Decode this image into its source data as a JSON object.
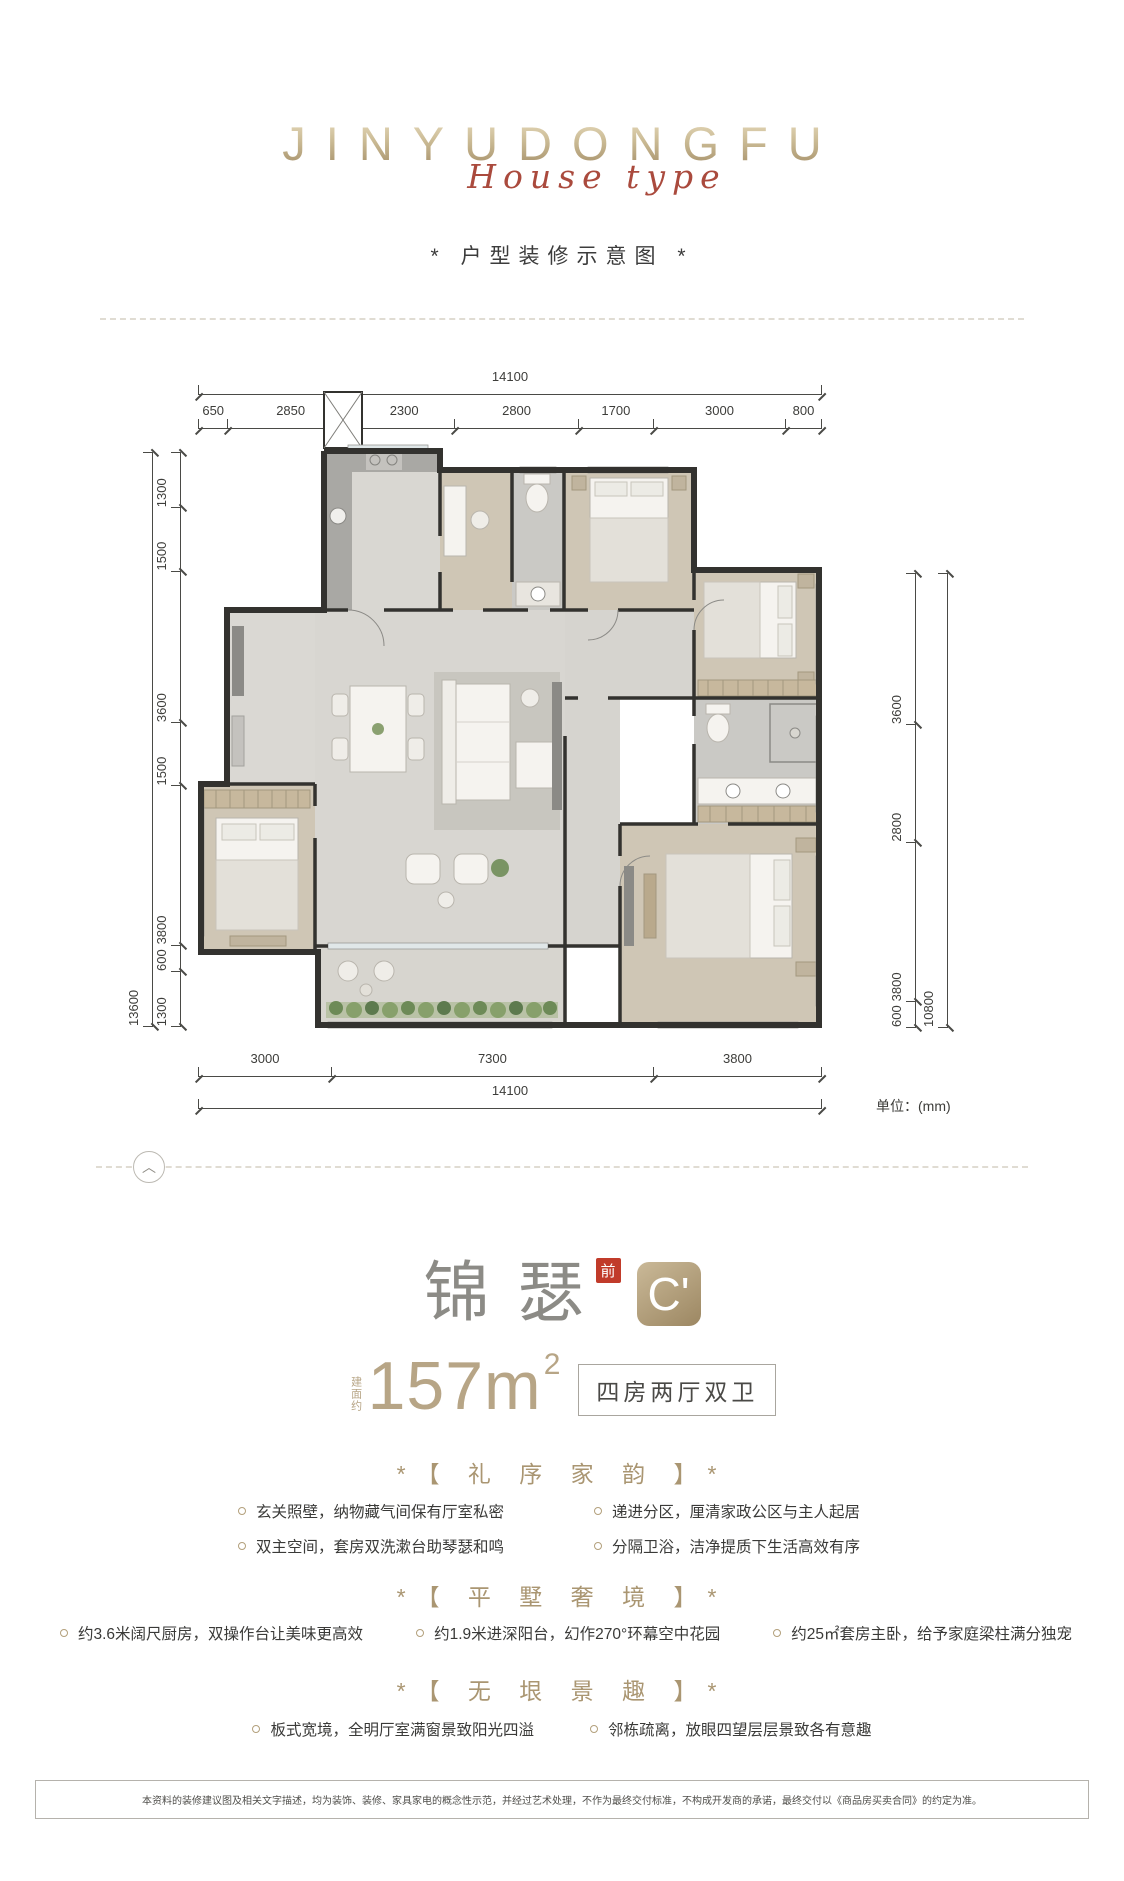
{
  "logo": {
    "brand": "JINYUDONGFU",
    "script": "House type",
    "subtitle": "* 户型装修示意图 *"
  },
  "floorplan": {
    "unit_note": "单位：(mm)",
    "dims": {
      "top": {
        "segments": [
          "650",
          "2850",
          "2300",
          "2800",
          "1700",
          "3000",
          "800"
        ],
        "total": [
          "14100"
        ]
      },
      "left": {
        "segments": [
          "1300",
          "1500",
          "3600",
          "1500",
          "3800",
          "600",
          "1300"
        ],
        "total": [
          "13600"
        ]
      },
      "right": {
        "segments": [
          "3600",
          "2800",
          "3800",
          "600"
        ],
        "total": [
          "10800"
        ]
      },
      "bottom": {
        "segments": [
          "3000",
          "7300",
          "3800"
        ],
        "total": [
          "14100"
        ]
      }
    }
  },
  "unit_card": {
    "name": "锦瑟",
    "seal": "前",
    "badge": "C'",
    "area_prefix": "建面约",
    "area_value": "157m",
    "area_sup": "2",
    "layout_tag": "四房两厅双卫"
  },
  "sections": [
    {
      "heading": "*【 礼 序 家 韵 】*",
      "bullets": [
        "玄关照壁，纳物藏气间保有厅室私密",
        "递进分区，厘清家政公区与主人起居",
        "双主空间，套房双洗漱台助琴瑟和鸣",
        "分隔卫浴，洁净提质下生活高效有序"
      ]
    },
    {
      "heading": "*【 平 墅 奢 境 】*",
      "bullets": [
        "约3.6米阔尺厨房，双操作台让美味更高效",
        "约1.9米进深阳台，幻作270°环幕空中花园",
        "约25㎡套房主卧，给予家庭梁柱满分独宠"
      ]
    },
    {
      "heading": "*【 无 垠 景 趣 】*",
      "bullets": [
        "板式宽境，全明厅室满窗景致阳光四溢",
        "邻栋疏离，放眼四望层层景致各有意趣"
      ]
    }
  ],
  "disclaimer": "本资料的装修建议图及相关文字描述，均为装饰、装修、家具家电的概念性示范，并经过艺术处理，不作为最终交付标准，不构成开发商的承诺，最终交付以《商品房买卖合同》的约定为准。",
  "colors": {
    "gold": "#b2a083",
    "script_red": "#aa4a3d",
    "seal_red": "#c13b2a"
  }
}
